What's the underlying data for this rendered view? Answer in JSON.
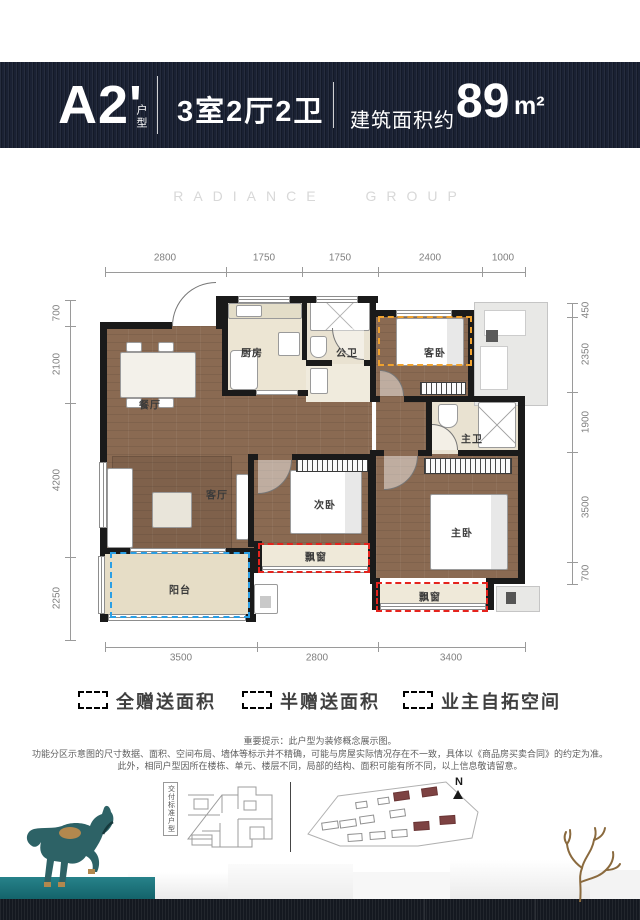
{
  "header": {
    "unit_code": "A2'",
    "unit_code_suffix": "户型",
    "layout": "3室2厅2卫",
    "area_prefix": "建筑面积约",
    "area_value": "89",
    "area_unit": "m²"
  },
  "watermark": "RADIANCE GROUP",
  "plan": {
    "dims_top": [
      "2800",
      "1750",
      "1750",
      "2400",
      "1000"
    ],
    "dims_bottom": [
      "3500",
      "2800",
      "3400"
    ],
    "dims_left": [
      "700",
      "2100",
      "4200",
      "2250"
    ],
    "dims_right": [
      "450",
      "2350",
      "1900",
      "3500",
      "700"
    ],
    "rooms": {
      "dining": "餐厅",
      "kitchen": "厨房",
      "guest_bath": "公卫",
      "guest_bedroom": "客卧",
      "master_bath": "主卫",
      "living": "客厅",
      "second_bedroom": "次卧",
      "master_bedroom": "主卧",
      "balcony": "阳台",
      "bay_window_1": "飘窗",
      "bay_window_2": "飘窗"
    }
  },
  "legend": [
    {
      "label": "全赠送面积",
      "color": "#e5231d"
    },
    {
      "label": "半赠送面积",
      "color": "#2a9fe5"
    },
    {
      "label": "业主自拓空间",
      "color": "#f0a22e"
    }
  ],
  "disclaimer": [
    "重要提示：此户型为装修概念展示图。",
    "功能分区示意图的尺寸数据、面积、空间布局、墙体等标示并不精确，可能与房屋实际情况存在不一致，具体以《商品房买卖合同》的约定为准。",
    "此外，相同户型因所在楼栋、单元、楼层不同，局部的结构、面积可能有所不同，以上信息敬请留意。"
  ],
  "footer": {
    "standard_type_label": "交付标准户型",
    "compass_label": "N"
  },
  "colors": {
    "banner_bg": "#1a2133",
    "teal_accent": "#18727a",
    "wood_floor": "#8a6a52",
    "wall": "#1a1a1a",
    "full_gift_red": "#e5231d",
    "half_gift_blue": "#2a9fe5",
    "owner_expand_orange": "#f0a22e"
  }
}
